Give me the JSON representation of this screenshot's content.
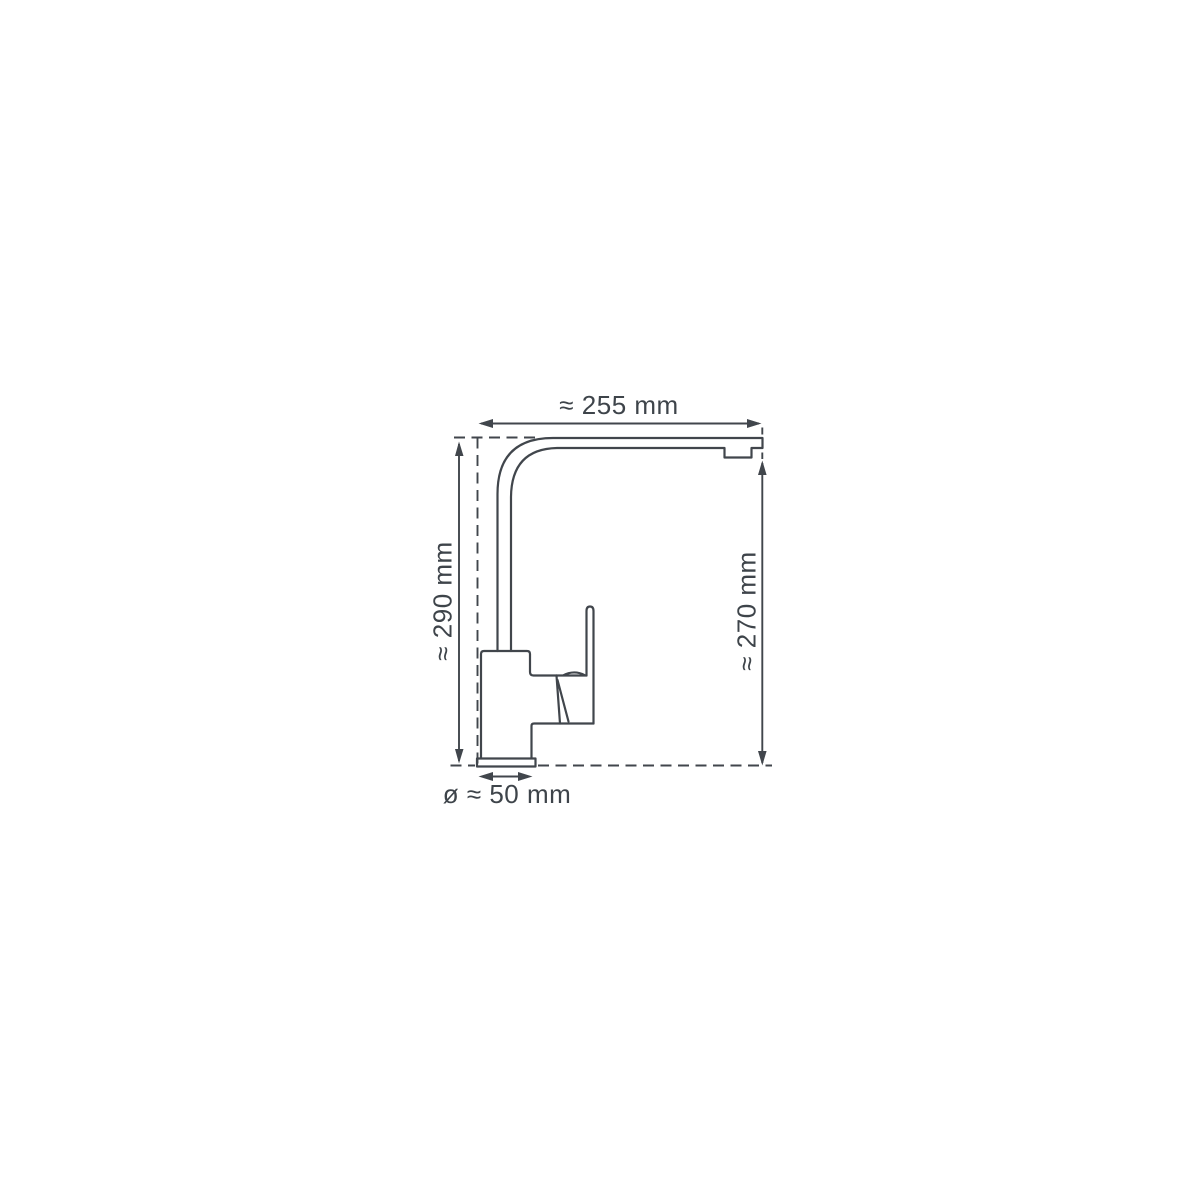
{
  "diagram": {
    "subject": "kitchen-faucet-side-view-dimension-drawing",
    "colors": {
      "background": "#ffffff",
      "line": "#41464c",
      "label": "#3e444a"
    },
    "dimensions": [
      {
        "id": "spout-reach",
        "label": "≈ 255 mm",
        "value": 255,
        "unit": "mm",
        "approx": true,
        "orientation": "horizontal",
        "position": "top"
      },
      {
        "id": "total-height",
        "label": "≈ 290 mm",
        "value": 290,
        "unit": "mm",
        "approx": true,
        "orientation": "vertical",
        "position": "left"
      },
      {
        "id": "spout-height",
        "label": "≈ 270 mm",
        "value": 270,
        "unit": "mm",
        "approx": true,
        "orientation": "vertical",
        "position": "right"
      },
      {
        "id": "base-diameter",
        "label": "ø ≈ 50 mm",
        "value": 50,
        "unit": "mm",
        "approx": true,
        "orientation": "horizontal",
        "position": "bottom"
      }
    ]
  }
}
